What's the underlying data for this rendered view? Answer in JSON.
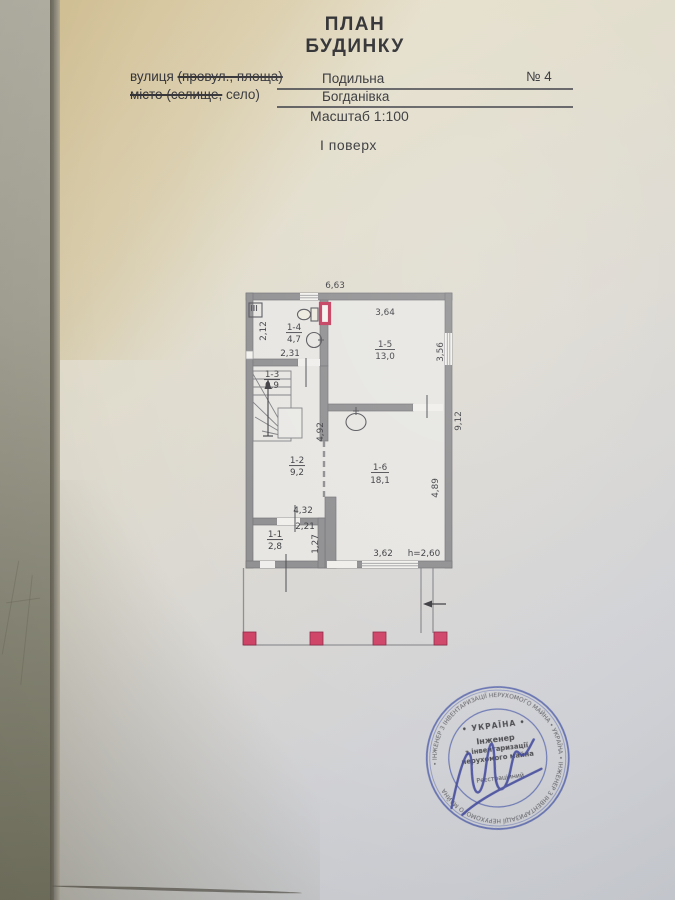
{
  "document": {
    "title_line1": "ПЛАН",
    "title_line2": "БУДИНКУ",
    "form": {
      "street_label": "вулиця",
      "street_label_struck": "(провул., площа)",
      "street_value": "Подильна",
      "house_number": "№ 4",
      "city_label_struck": "місто (селище,",
      "city_label_rest": "село)",
      "city_value": "Богданівка",
      "scale_label": "Масштаб 1:100",
      "floor_label": "І поверх"
    }
  },
  "plan": {
    "rooms": {
      "r11": {
        "num": "1-1",
        "area": "2,8"
      },
      "r12": {
        "num": "1-2",
        "area": "9,2"
      },
      "r13": {
        "num": "1-3",
        "area": "0,9"
      },
      "r14": {
        "num": "1-4",
        "area": "4,7"
      },
      "r15": {
        "num": "1-5",
        "area": "13,0"
      },
      "r16": {
        "num": "1-6",
        "area": "18,1"
      }
    },
    "dims": {
      "top": "6,63",
      "d364": "3,64",
      "d212": "2,12",
      "d231": "2,31",
      "d356": "3,56",
      "d912": "9,12",
      "d492": "4,92",
      "d489": "4,89",
      "d432": "4,32",
      "d221": "2,21",
      "d127": "1,27",
      "d362": "3,62",
      "height": "h=2,60"
    }
  },
  "stamp": {
    "ring_text": "• ІНЖЕНЕР З ІНВЕНТАРИЗАЦІЇ НЕРУХОМОГО МАЙНА • УКРАЇНА • ІНЖЕНЕР З ІНВЕНТАРИЗАЦІЇ НЕРУХОМОГО МАЙНА",
    "country": "• УКРАЇНА •",
    "line1": "Інженер",
    "line2": "з інвентаризації",
    "line3": "нерухомого майна",
    "line4": "Реєстраційний"
  },
  "colors": {
    "wall": "#8e8e90",
    "accent_red": "#c2395b",
    "stamp_blue": "#4050a5",
    "ink": "#3a3a3f"
  }
}
